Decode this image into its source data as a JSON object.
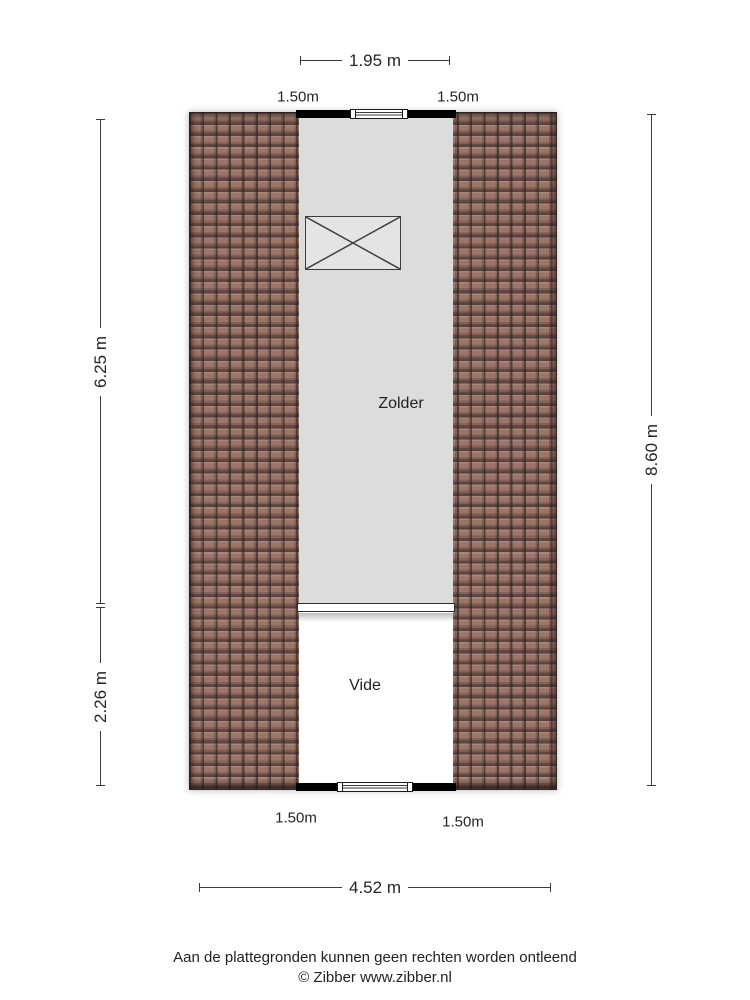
{
  "floorplan": {
    "rooms": [
      {
        "label": "Zolder"
      },
      {
        "label": "Vide"
      }
    ],
    "dimensions": {
      "top_width": "1.95 m",
      "clearance_top_left": "1.50m",
      "clearance_top_right": "1.50m",
      "left_upper": "6.25 m",
      "left_lower": "2.26 m",
      "right_total": "8.60 m",
      "clearance_bottom_left": "1.50m",
      "clearance_bottom_right": "1.50m",
      "bottom_width": "4.52 m"
    },
    "colors": {
      "roof_tile": "#9d7468",
      "roof_joint": "#3f332d",
      "zolder_floor": "#dcdcdc",
      "vide_floor": "#ffffff",
      "wall": "#000000",
      "dimension_line": "#3a3a3a",
      "text": "#222222"
    }
  },
  "footer": {
    "disclaimer": "Aan de plattegronden kunnen geen rechten worden ontleend",
    "credit": "© Zibber www.zibber.nl"
  }
}
